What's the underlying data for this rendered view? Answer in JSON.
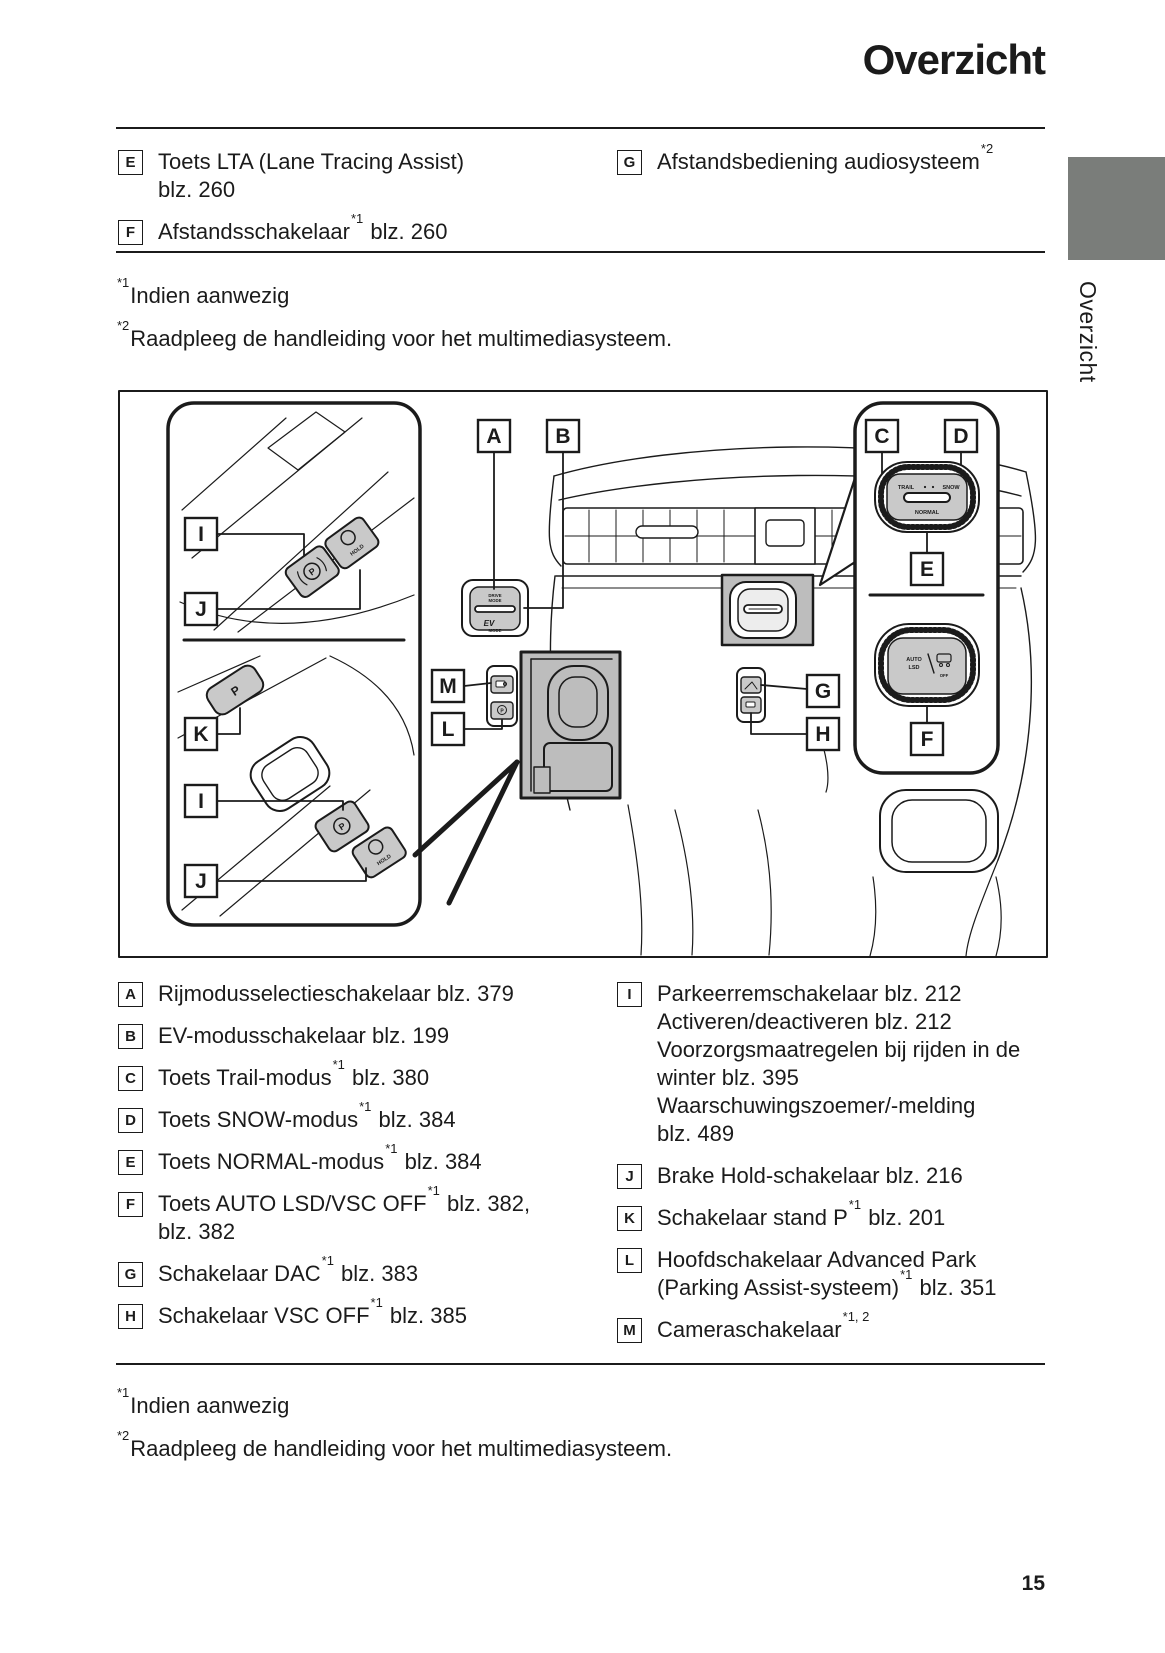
{
  "page": {
    "title": "Overzicht",
    "side_tab": "Overzicht",
    "page_number": "15"
  },
  "top_legend": [
    {
      "key": "E",
      "segments": [
        "Toets LTA (Lane Tracing Assist)\nblz. 260"
      ]
    },
    {
      "key": "F",
      "segments": [
        "Afstandsschakelaar",
        "^*1",
        " blz. 260"
      ]
    },
    {
      "key": "G",
      "segments": [
        "Afstandsbediening audiosysteem",
        "^*2"
      ]
    }
  ],
  "footnotes": [
    {
      "marker": "*1",
      "text": "Indien aanwezig"
    },
    {
      "marker": "*2",
      "text": "Raadpleeg de handleiding voor het multimediasysteem."
    }
  ],
  "diagram": {
    "callouts": {
      "a": "A",
      "b": "B",
      "c": "C",
      "d": "D",
      "e": "E",
      "f": "F",
      "g": "G",
      "h": "H",
      "i": "I",
      "j": "J",
      "k": "K",
      "l": "L",
      "m": "M"
    },
    "labels": {
      "trail": "TRAIL",
      "snow": "SNOW",
      "normal": "NORMAL",
      "auto": "AUTO",
      "lsd": "LSD",
      "off": "OFF",
      "hold": "HOLD",
      "p": "P",
      "ev": "EV",
      "mode": "MODE",
      "drive": "DRIVE"
    }
  },
  "bottom_legend": {
    "left": [
      {
        "key": "A",
        "segments": [
          "Rijmodusselectieschakelaar blz. 379"
        ]
      },
      {
        "key": "B",
        "segments": [
          "EV-modusschakelaar blz. 199"
        ]
      },
      {
        "key": "C",
        "segments": [
          "Toets Trail-modus",
          "^*1",
          " blz. 380"
        ]
      },
      {
        "key": "D",
        "segments": [
          "Toets SNOW-modus",
          "^*1",
          " blz. 384"
        ]
      },
      {
        "key": "E",
        "segments": [
          "Toets NORMAL-modus",
          "^*1",
          " blz. 384"
        ]
      },
      {
        "key": "F",
        "segments": [
          "Toets AUTO LSD/VSC OFF",
          "^*1",
          " blz. 382,\nblz. 382"
        ]
      },
      {
        "key": "G",
        "segments": [
          "Schakelaar DAC",
          "^*1",
          " blz. 383"
        ]
      },
      {
        "key": "H",
        "segments": [
          "Schakelaar VSC OFF",
          "^*1",
          " blz. 385"
        ]
      }
    ],
    "right": [
      {
        "key": "I",
        "segments": [
          "Parkeerremschakelaar blz. 212\nActiveren/deactiveren blz. 212\nVoorzorgsmaatregelen bij rijden in de\nwinter blz. 395\nWaarschuwingszoemer/-melding\nblz. 489"
        ]
      },
      {
        "key": "J",
        "segments": [
          "Brake Hold-schakelaar blz. 216"
        ]
      },
      {
        "key": "K",
        "segments": [
          "Schakelaar stand P",
          "^*1",
          " blz. 201"
        ]
      },
      {
        "key": "L",
        "segments": [
          "Hoofdschakelaar Advanced Park\n(Parking Assist-systeem)",
          "^*1",
          " blz. 351"
        ]
      },
      {
        "key": "M",
        "segments": [
          "Cameraschakelaar",
          "^*1, 2",
          ""
        ]
      }
    ]
  },
  "colors": {
    "side_tab_gray": "#7a7d7a",
    "highlight_gray": "#bdbdbd",
    "button_gray": "#c9c9c9",
    "line": "#1b1b1b"
  }
}
